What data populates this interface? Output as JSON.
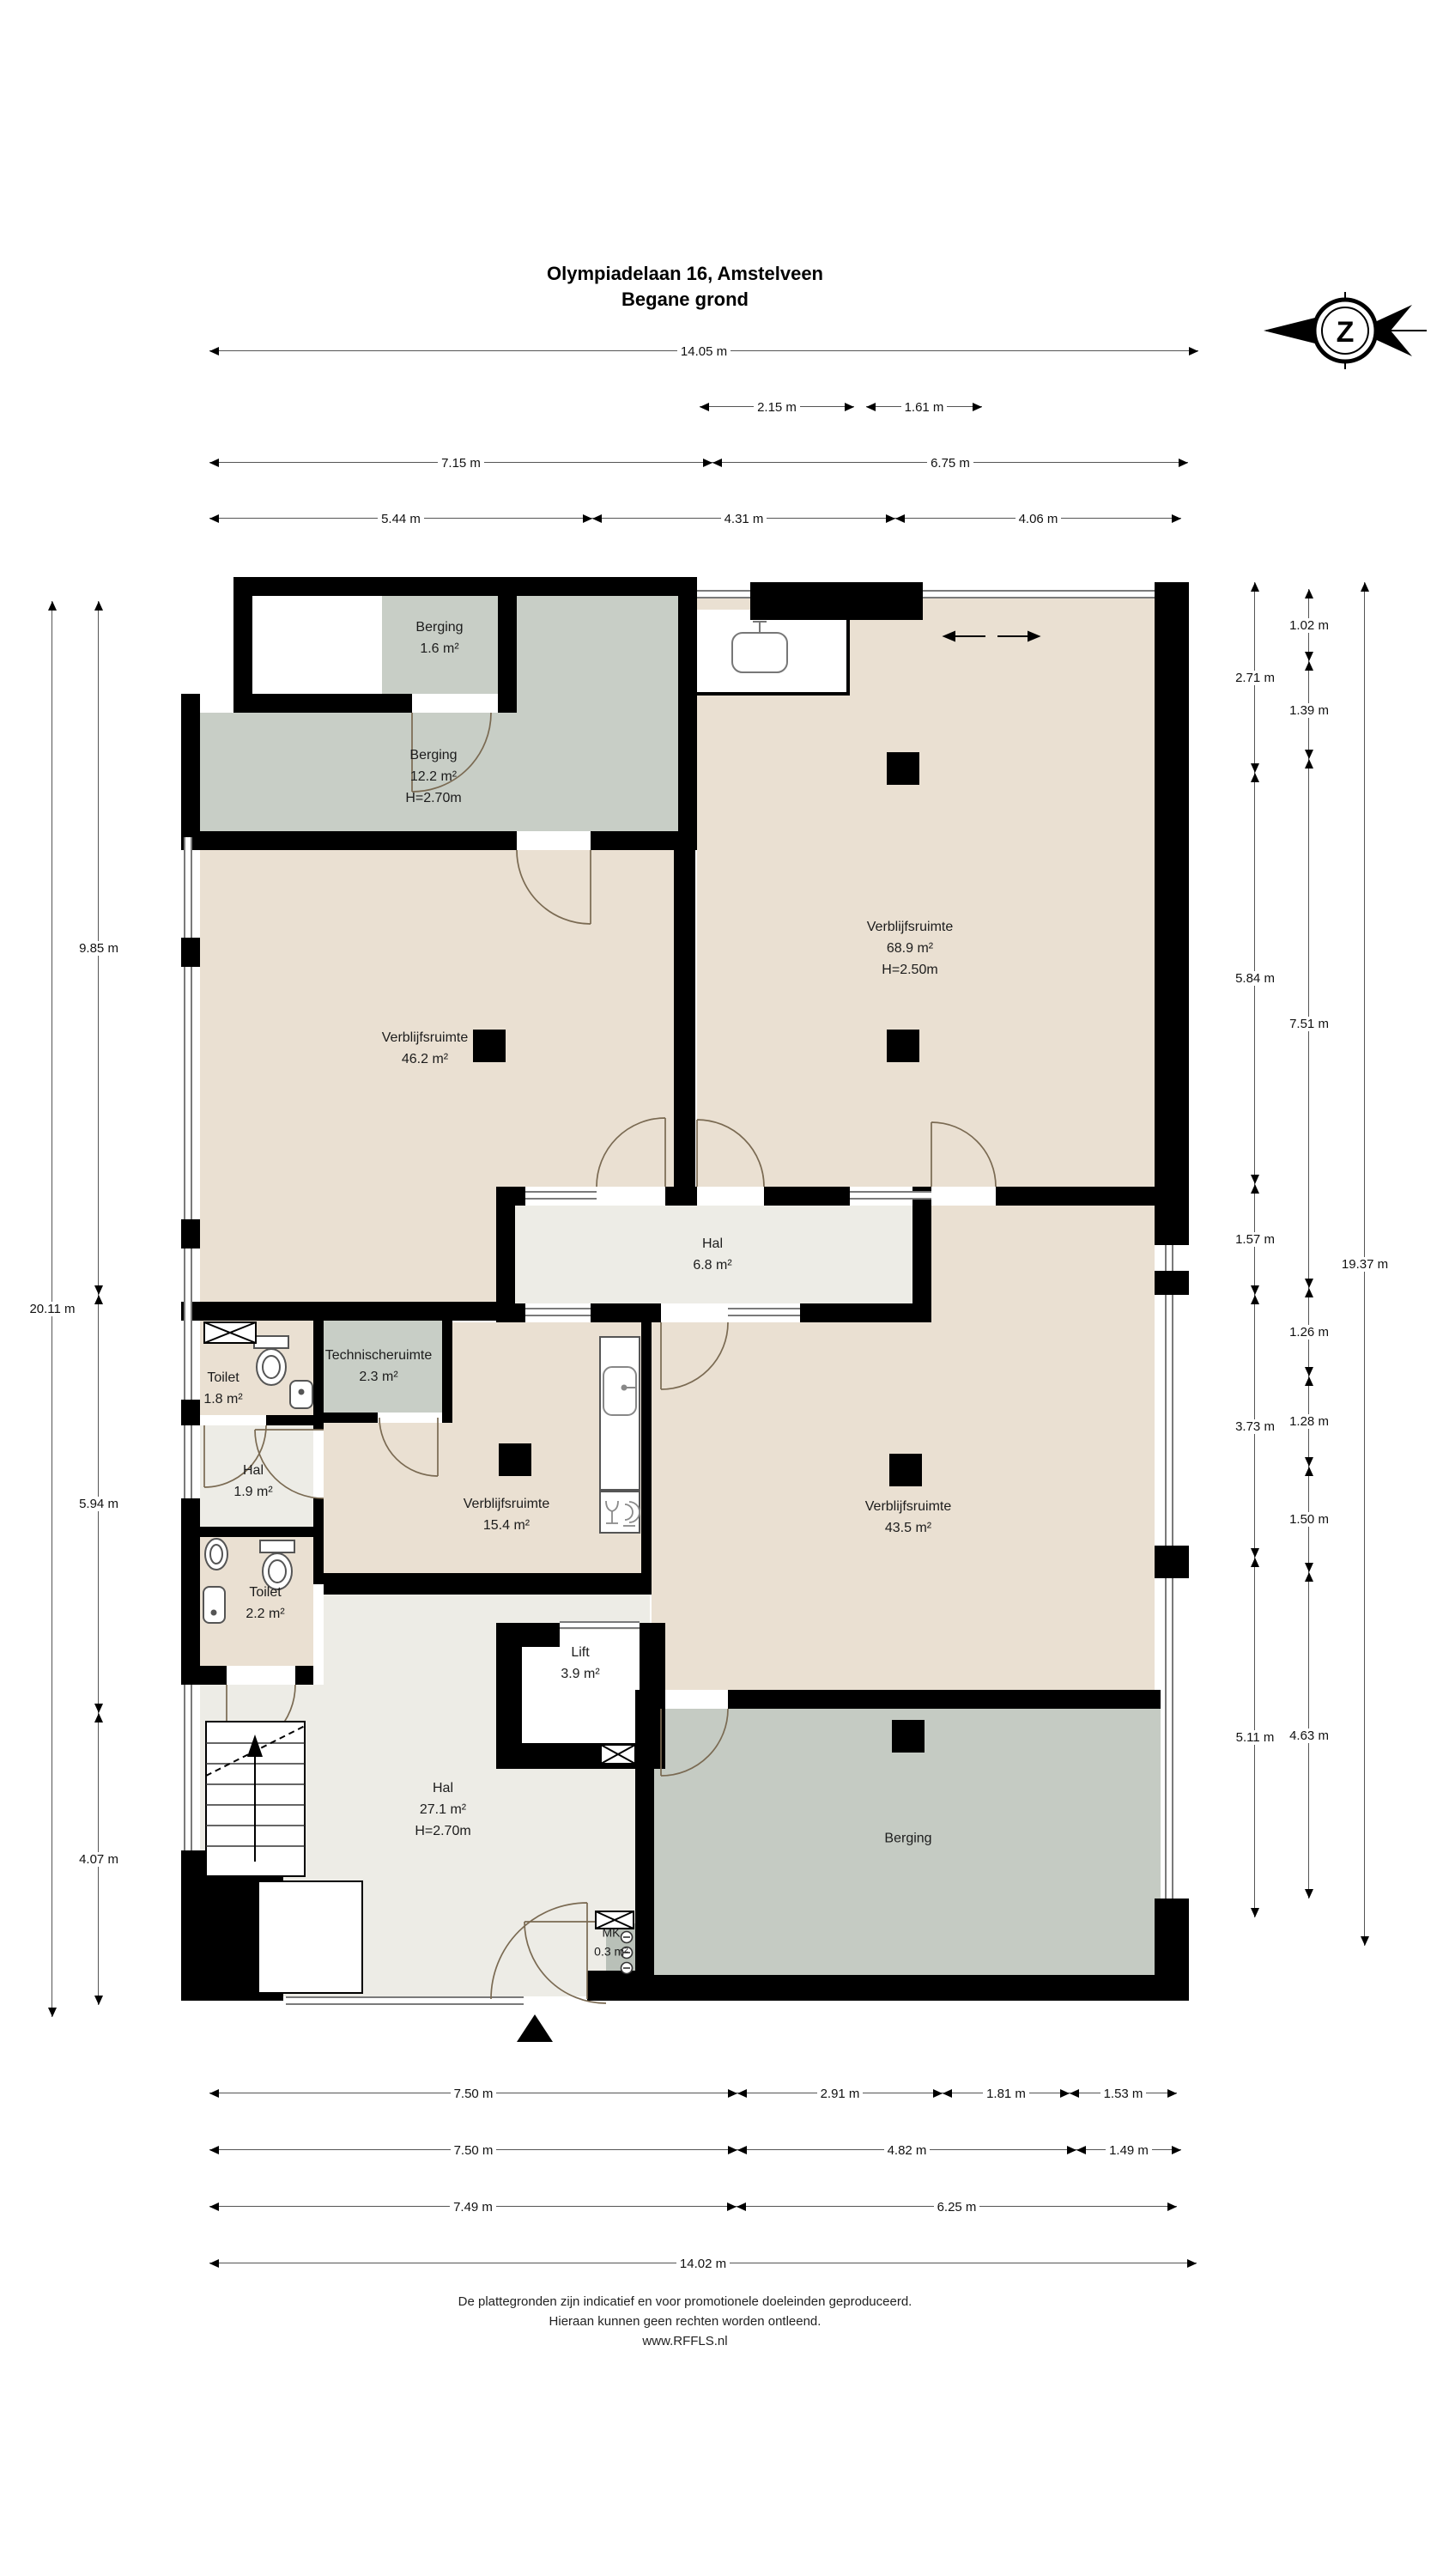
{
  "header": {
    "title_line1": "Olympiadelaan 16, Amstelveen",
    "title_line2": "Begane grond"
  },
  "compass": {
    "letter": "Z"
  },
  "rooms": {
    "berging_1_6": {
      "name": "Berging",
      "area": "1.6 m²"
    },
    "berging_12_2": {
      "name": "Berging",
      "area": "12.2 m²",
      "height": "H=2.70m"
    },
    "verblijfsruimte_68_9": {
      "name": "Verblijfsruimte",
      "area": "68.9 m²",
      "height": "H=2.50m"
    },
    "verblijfsruimte_46_2": {
      "name": "Verblijfsruimte",
      "area": "46.2 m²"
    },
    "hal_6_8": {
      "name": "Hal",
      "area": "6.8 m²"
    },
    "technische_ruimte": {
      "name": "Technischeruimte",
      "area": "2.3 m²"
    },
    "toilet_1_8": {
      "name": "Toilet",
      "area": "1.8 m²"
    },
    "hal_1_9": {
      "name": "Hal",
      "area": "1.9 m²"
    },
    "toilet_2_2": {
      "name": "Toilet",
      "area": "2.2 m²"
    },
    "verblijfsruimte_15_4": {
      "name": "Verblijfsruimte",
      "area": "15.4 m²"
    },
    "verblijfsruimte_43_5": {
      "name": "Verblijfsruimte",
      "area": "43.5 m²"
    },
    "lift": {
      "name": "Lift",
      "area": "3.9 m²"
    },
    "hal_27_1": {
      "name": "Hal",
      "area": "27.1 m²",
      "height": "H=2.70m"
    },
    "mk": {
      "name": "MK",
      "area": "0.3 m²"
    },
    "berging_groot": {
      "name": "Berging"
    }
  },
  "dimensions": {
    "top": {
      "row1": [
        "14.05 m"
      ],
      "row2": [
        "2.15 m",
        "1.61 m"
      ],
      "row3": [
        "7.15 m",
        "6.75 m"
      ],
      "row4": [
        "5.44 m",
        "4.31 m",
        "4.06 m"
      ]
    },
    "bottom": {
      "row1": [
        "7.50 m",
        "2.91 m",
        "1.81 m",
        "1.53 m"
      ],
      "row2": [
        "7.50 m",
        "4.82 m",
        "1.49 m"
      ],
      "row3": [
        "7.49 m",
        "6.25 m"
      ],
      "row4": [
        "14.02 m"
      ]
    },
    "left": {
      "outer": "20.11 m",
      "inner": [
        "9.85 m",
        "5.94 m",
        "4.07 m"
      ]
    },
    "right": {
      "inner": [
        "2.71 m",
        "5.84 m",
        "1.57 m",
        "3.73 m",
        "5.11 m"
      ],
      "middle": [
        "1.02 m",
        "1.39 m",
        "7.51 m",
        "1.26 m",
        "1.28 m",
        "1.50 m",
        "4.63 m"
      ],
      "outer": "19.37 m"
    }
  },
  "footer": {
    "line1": "De plattegronden zijn indicatief en voor promotionele doeleinden geproduceerd.",
    "line2": "Hieraan kunnen geen rechten worden ontleend.",
    "line3": "www.RFFLS.nl"
  },
  "colors": {
    "wall": "#000000",
    "room_beige": "#EAE0D2",
    "room_gray": "#C8CEC6",
    "room_gray_dark": "#C5CBC3",
    "room_light": "#EDECE6",
    "arc": "#7a6a52"
  }
}
